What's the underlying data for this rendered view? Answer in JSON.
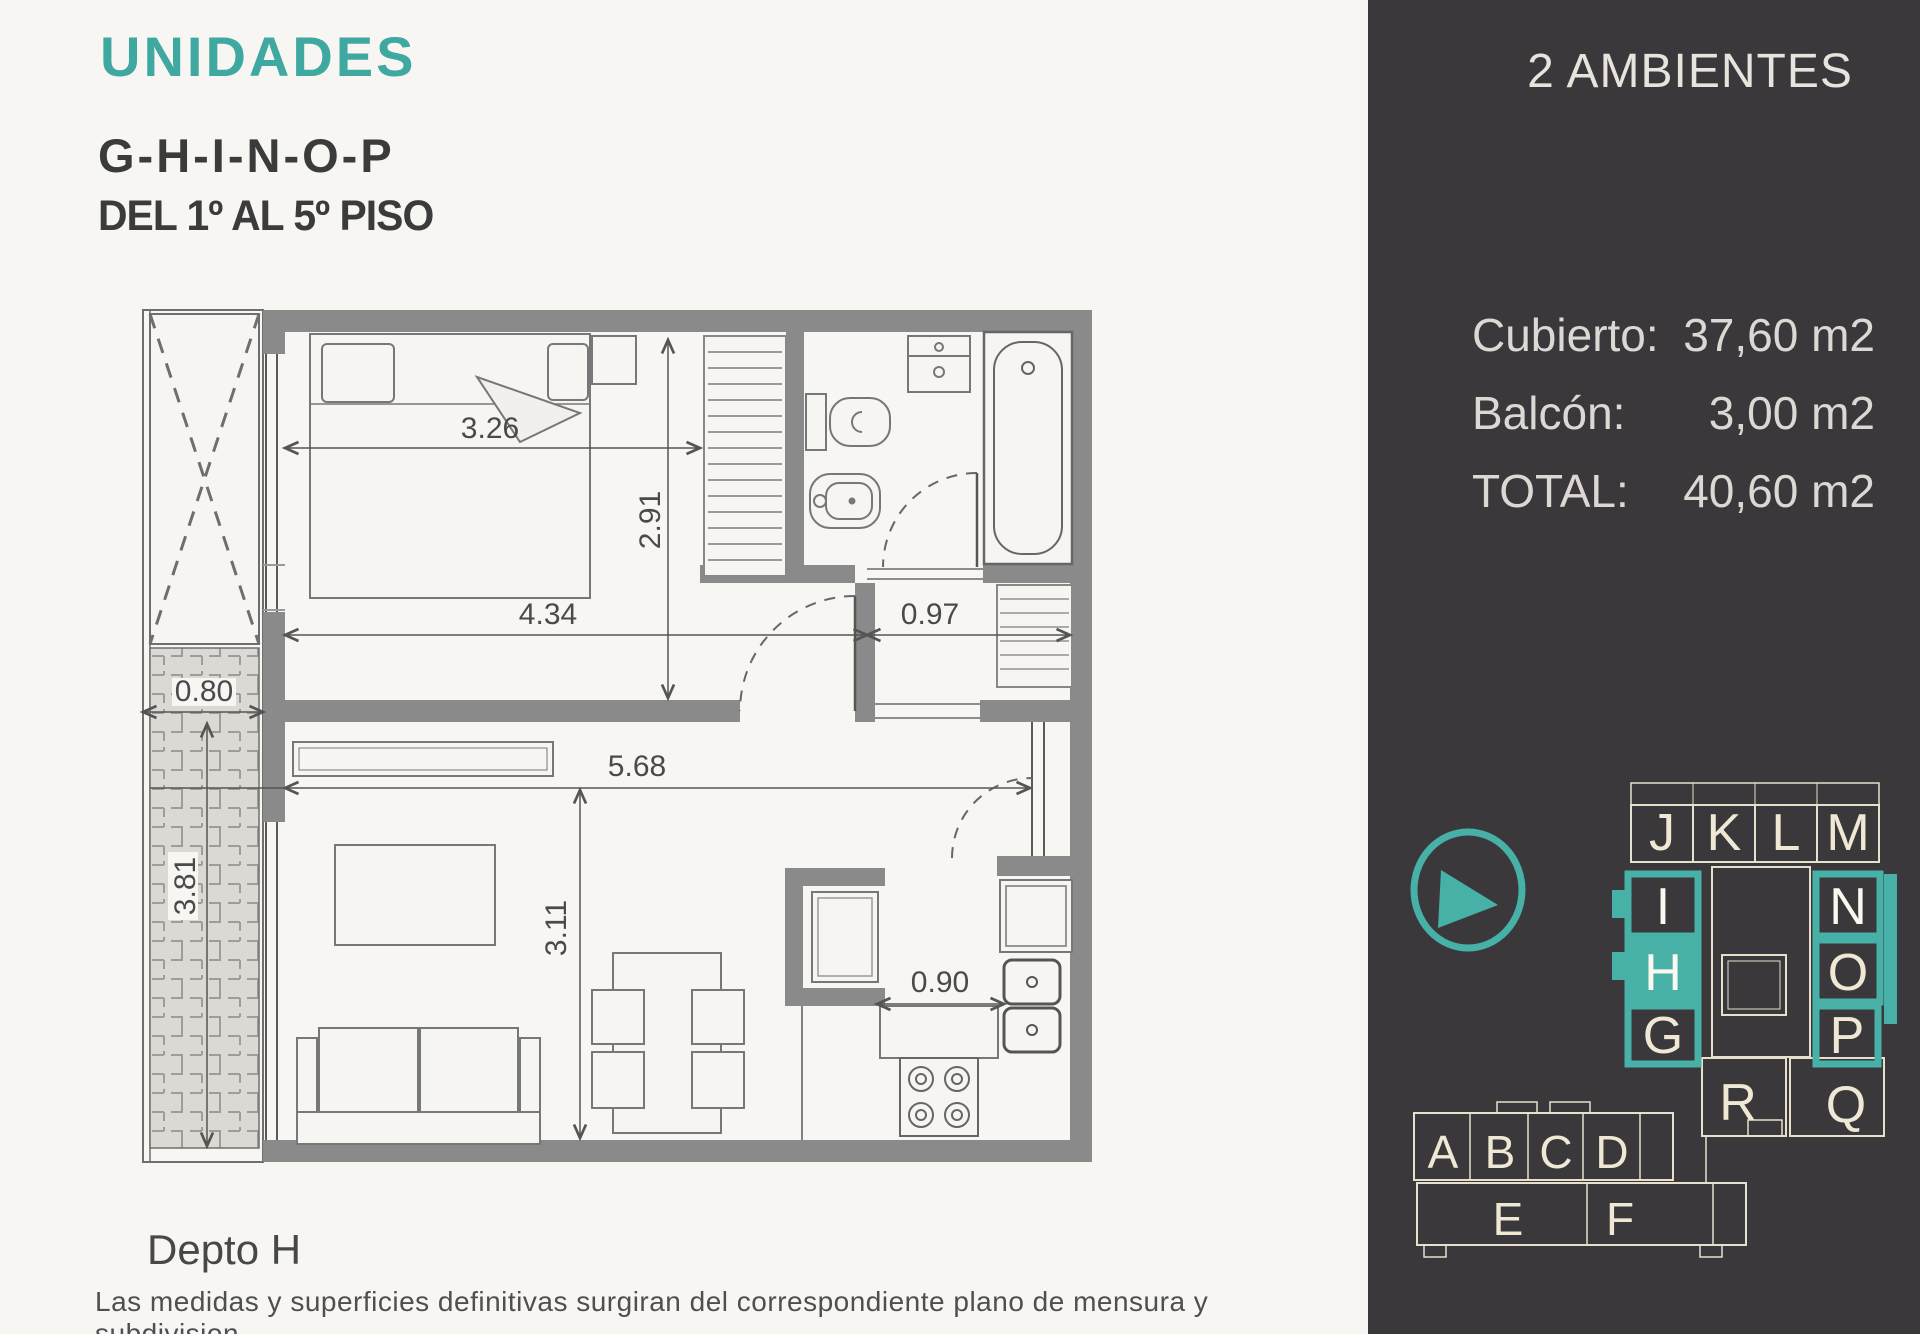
{
  "title": {
    "brand": "UNIDADES",
    "units": "G-H-I-N-O-P",
    "floors": "DEL 1º AL 5º PISO"
  },
  "plan": {
    "unit_label": "Depto H",
    "dims": {
      "bed_width": "3.26",
      "bedroom_depth": "2.91",
      "bedroom_width": "4.34",
      "bath_width": "0.97",
      "balcony_door": "0.80",
      "balcony_length": "3.81",
      "living_width": "5.68",
      "living_depth": "3.11",
      "kitchen_counter": "0.90"
    }
  },
  "disclaimer": "Las medidas y superficies definitivas surgiran del correspondiente plano de mensura y subdivision",
  "sidebar": {
    "header": "2 AMBIENTES",
    "areas": [
      {
        "label": "Cubierto:",
        "value": "37,60 m2"
      },
      {
        "label": "Balcón:",
        "value": "3,00 m2"
      },
      {
        "label": "TOTAL:",
        "value": "40,60 m2"
      }
    ],
    "keyplan": {
      "letters": [
        "J",
        "K",
        "L",
        "M",
        "I",
        "H",
        "G",
        "N",
        "O",
        "P",
        "R",
        "Q",
        "A",
        "B",
        "C",
        "D",
        "E",
        "F"
      ],
      "current_unit": "H"
    }
  },
  "colors": {
    "accent_teal": "#3fa8a0",
    "keyplan_teal": "#47b1a8",
    "keyplan_cream": "#eee8d4",
    "sidebar_bg": "#3b383b",
    "wall_gray": "#8a8a8a",
    "page_bg": "#f8f6f3"
  }
}
